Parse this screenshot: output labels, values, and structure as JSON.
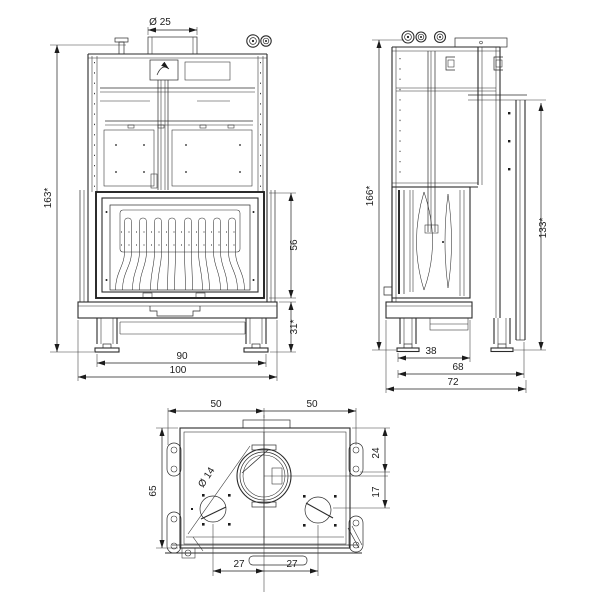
{
  "front_view": {
    "dims": {
      "flue_diameter": "Ø 25",
      "overall_height": "163*",
      "glass_height": "56",
      "plinth_height": "31*",
      "body_width": "90",
      "overall_width": "100"
    }
  },
  "side_view": {
    "dims": {
      "overall_height": "166*",
      "rear_height": "133*",
      "firebox_depth": "38",
      "body_depth": "68",
      "overall_depth": "72"
    }
  },
  "top_view": {
    "dims": {
      "half_width_left": "50",
      "half_width_right": "50",
      "overall_depth": "65",
      "pipe_diameter": "Ø 14",
      "flue_offset_back": "24",
      "flue_offset_front": "17",
      "pipe_spacing_left": "27",
      "pipe_spacing_right": "27"
    }
  },
  "colors": {
    "line": "#2b2b2b",
    "background": "#ffffff"
  }
}
